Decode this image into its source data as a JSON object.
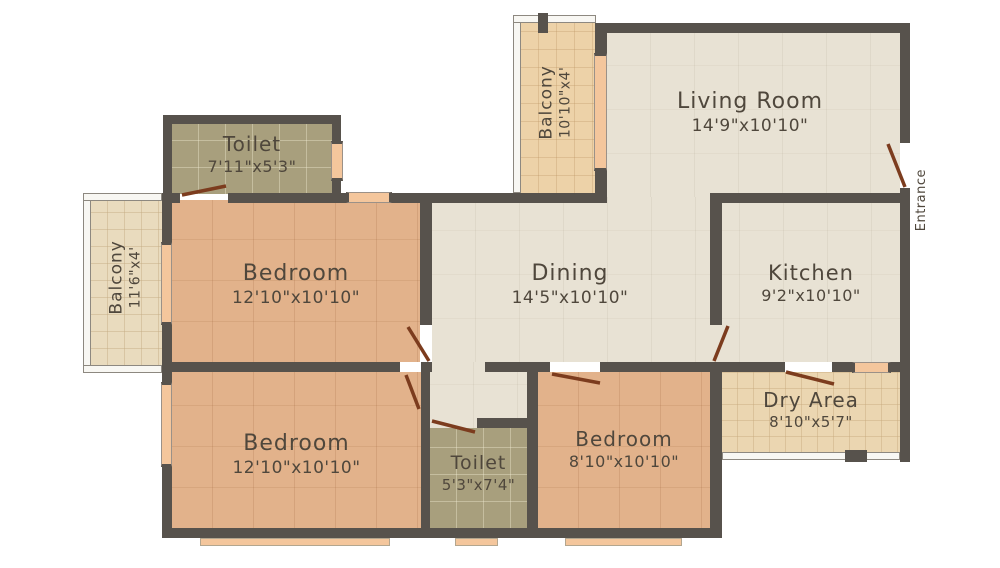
{
  "meta": {
    "title": "Apartment floor plan"
  },
  "rooms": {
    "toilet1": {
      "name": "Toilet",
      "dims": "7'11\"x5'3\""
    },
    "balcony_top": {
      "name": "Balcony",
      "dims": "10'10\"x4'"
    },
    "living": {
      "name": "Living Room",
      "dims": "14'9\"x10'10\""
    },
    "balcony_left": {
      "name": "Balcony",
      "dims": "11'6\"x4'"
    },
    "bedroom1": {
      "name": "Bedroom",
      "dims": "12'10\"x10'10\""
    },
    "dining": {
      "name": "Dining",
      "dims": "14'5\"x10'10\""
    },
    "kitchen": {
      "name": "Kitchen",
      "dims": "9'2\"x10'10\""
    },
    "bedroom2": {
      "name": "Bedroom",
      "dims": "12'10\"x10'10\""
    },
    "toilet2": {
      "name": "Toilet",
      "dims": "5'3\"x7'4\""
    },
    "bedroom3": {
      "name": "Bedroom",
      "dims": "8'10\"x10'10\""
    },
    "dry_area": {
      "name": "Dry Area",
      "dims": "8'10\"x5'7\""
    },
    "entrance": {
      "label": "Entrance"
    }
  },
  "colors": {
    "wall": "#57524c",
    "floor_common": "#e8e2d4",
    "floor_bedroom": "#e2b28b",
    "floor_toilet": "#a89f7d",
    "floor_balcony_top": "#edd2a8",
    "floor_balcony_left": "#e9dbbe",
    "floor_dry_area": "#ebd6b1",
    "window": "#f4c69c",
    "door": "#7c3c1e",
    "text": "#4f473c"
  }
}
